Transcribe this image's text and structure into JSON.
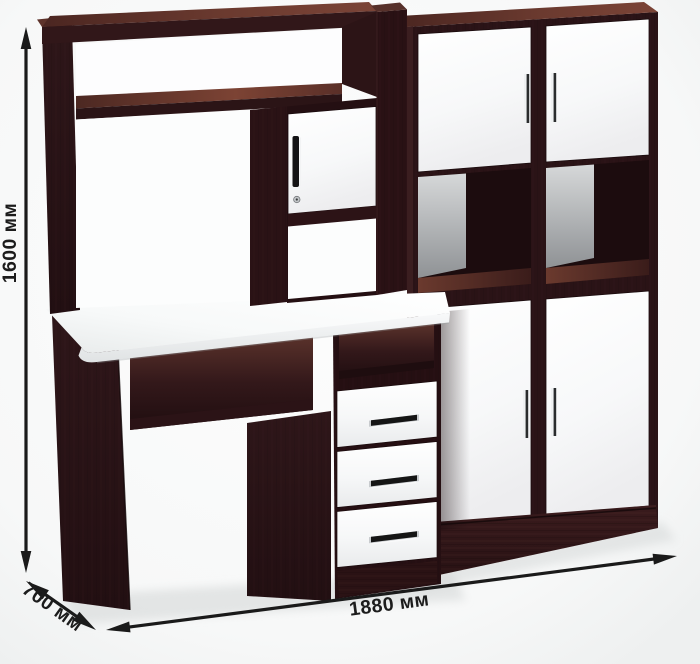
{
  "annotations": {
    "height": {
      "label": "1600 мм"
    },
    "width": {
      "label": "1880 мм"
    },
    "depth": {
      "label": "700 мм"
    },
    "line_color": "#1a1a1a",
    "text_color": "#1c1c1c"
  },
  "palette": {
    "wenge_front": "#2e161a",
    "wenge_shadow": "#1d0d0f",
    "wenge_top_light": "#7b4437",
    "facade_white": "#fbfcfd",
    "back_panel_gray": "#aeb1b4",
    "chrome_handle": "#d9dbdd",
    "background": "#f5f6f6"
  }
}
